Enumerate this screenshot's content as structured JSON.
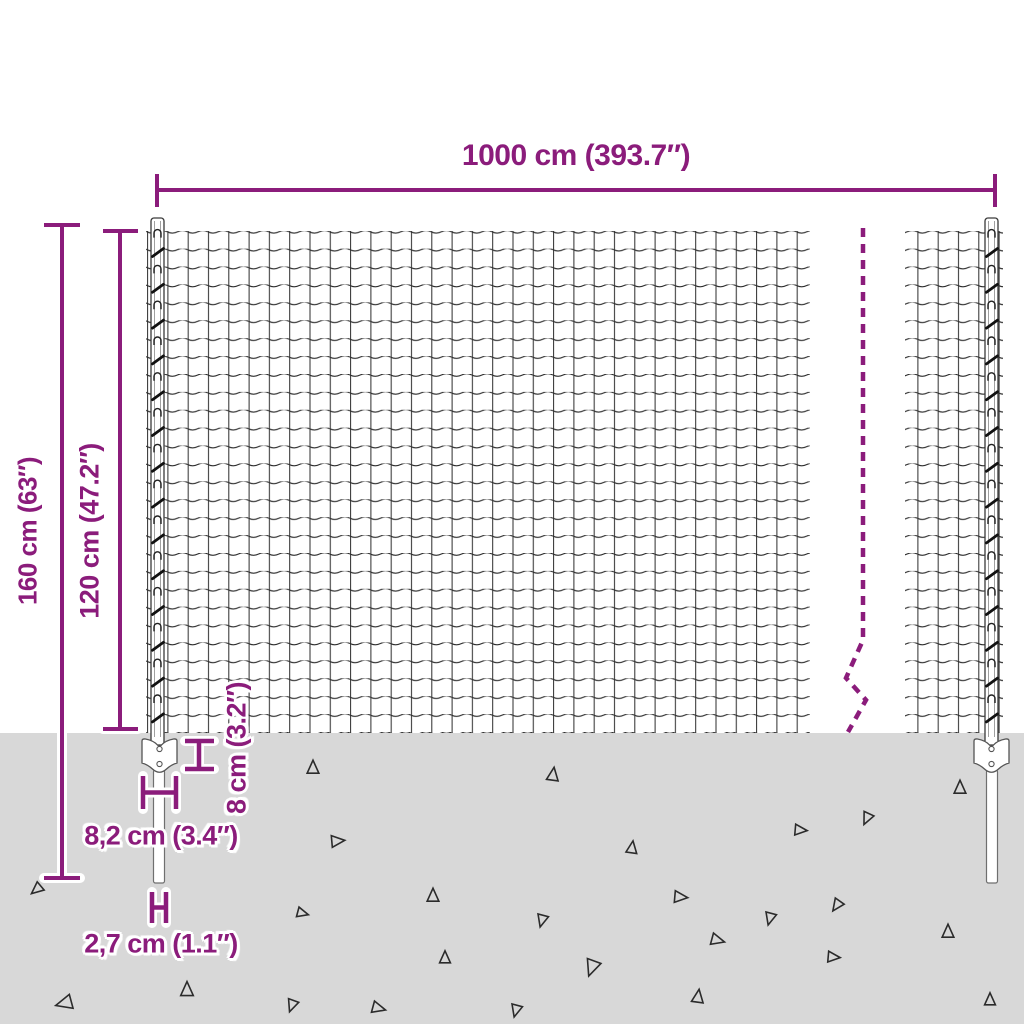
{
  "diagram_title": "Wire mesh fence with posts and spike anchors — dimension diagram",
  "dimensions": {
    "total_width": "1000 cm (393.7″)",
    "total_height": "160 cm (63″)",
    "fence_height": "120 cm (47.2″)",
    "anchor_plate_depth": "8 cm (3.2″)",
    "anchor_plate_width": "8,2 cm (3.4″)",
    "spike_width": "2,7 cm (1.1″)"
  },
  "colors": {
    "accent_purple": "#8B1C7B",
    "ground_gray": "#D8D8D8",
    "wire_dark": "#2B2B2B",
    "halo_white": "#FFFFFF"
  }
}
